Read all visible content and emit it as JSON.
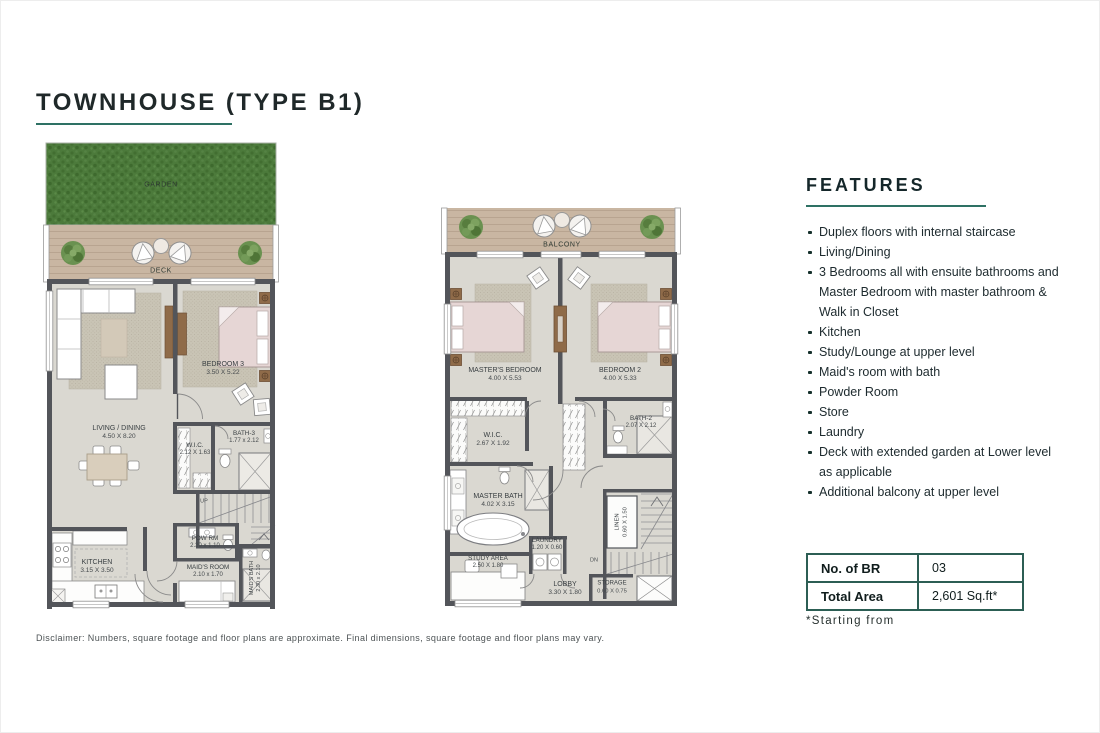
{
  "title": "TOWNHOUSE (TYPE B1)",
  "features": {
    "heading": "FEATURES",
    "items": [
      "Duplex floors with internal staircase",
      "Living/Dining",
      "3 Bedrooms all with ensuite bathrooms and Master Bedroom with master bathroom & Walk in Closet",
      "Kitchen",
      "Study/Lounge at upper level",
      "Maid's room with bath",
      "Powder Room",
      "Store",
      "Laundry",
      "Deck with extended garden at Lower level as applicable",
      "Additional balcony at upper level"
    ]
  },
  "spec_table": {
    "rows": [
      {
        "label": "No. of BR",
        "value": "03"
      },
      {
        "label": "Total Area",
        "value": "2,601 Sq.ft*"
      }
    ]
  },
  "footnote": "*Starting from",
  "disclaimer": "Disclaimer: Numbers, square footage and floor plans are approximate. Final dimensions, square footage and floor plans may vary.",
  "plans": {
    "lower": {
      "garden_label": "GARDEN",
      "deck_label": "DECK",
      "stairs_label": "UP",
      "rooms": [
        {
          "name": "LIVING / DINING",
          "dim": "4.50 X 8.20"
        },
        {
          "name": "BEDROOM 3",
          "dim": "3.50 X 5.22"
        },
        {
          "name": "W.I.C.",
          "dim": "2.12 X 1.63"
        },
        {
          "name": "BATH-3",
          "dim": "1.77 x 2.12"
        },
        {
          "name": "KITCHEN",
          "dim": "3.15 X 3.50"
        },
        {
          "name": "POW RM",
          "dim": "2.30 x 1.10"
        },
        {
          "name": "MAID'S ROOM",
          "dim": "2.10 x 1.70"
        },
        {
          "name": "MAID'S BATH",
          "dim": "2.30 x 2.10"
        }
      ]
    },
    "upper": {
      "balcony_label": "BALCONY",
      "stairs_label": "DN",
      "rooms": [
        {
          "name": "MASTER'S BEDROOM",
          "dim": "4.00 X 5.53"
        },
        {
          "name": "BEDROOM 2",
          "dim": "4.00 X 5.33"
        },
        {
          "name": "W.I.C.",
          "dim": "2.67 X 1.92"
        },
        {
          "name": "BATH-2",
          "dim": "2.07 X 2.12"
        },
        {
          "name": "MASTER BATH",
          "dim": "4.02 X 3.15"
        },
        {
          "name": "LAUNDRY",
          "dim": "1.20 X 0.60"
        },
        {
          "name": "LINEN",
          "dim": "0.60 X 1.50"
        },
        {
          "name": "STUDY AREA",
          "dim": "2.50 X 1.80"
        },
        {
          "name": "LOBBY",
          "dim": "3.30 X 1.80"
        },
        {
          "name": "STORAGE",
          "dim": "0.60 X 0.75"
        }
      ]
    }
  },
  "colors": {
    "accent_teal": "#2e7164",
    "table_border": "#2c5e54",
    "garden_green": "#4c7a3b",
    "deck_tan": "#c9b6a2",
    "floor_gray": "#dad8d1",
    "wall_dark": "#53555a",
    "bed_pink": "#e6d6d5"
  }
}
